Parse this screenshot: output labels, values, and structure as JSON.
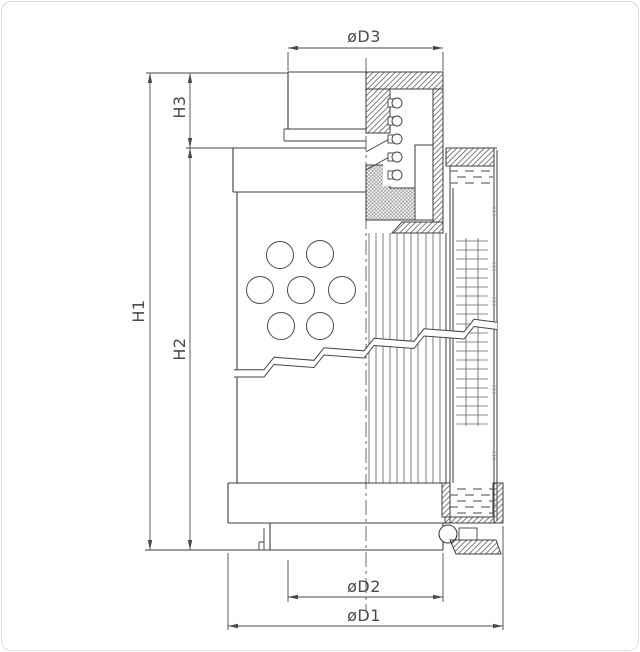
{
  "drawing": {
    "dimension_labels": {
      "d3": "øD3",
      "h3": "H3",
      "h1": "H1",
      "h2": "H2",
      "d2": "øD2",
      "d1": "øD1"
    },
    "colors": {
      "outline": "#3d3d3d",
      "dimension": "#4a4a4a",
      "hatch": "#6a6a6a",
      "background": "#ffffff",
      "frame_border": "#dcdcdc"
    }
  }
}
